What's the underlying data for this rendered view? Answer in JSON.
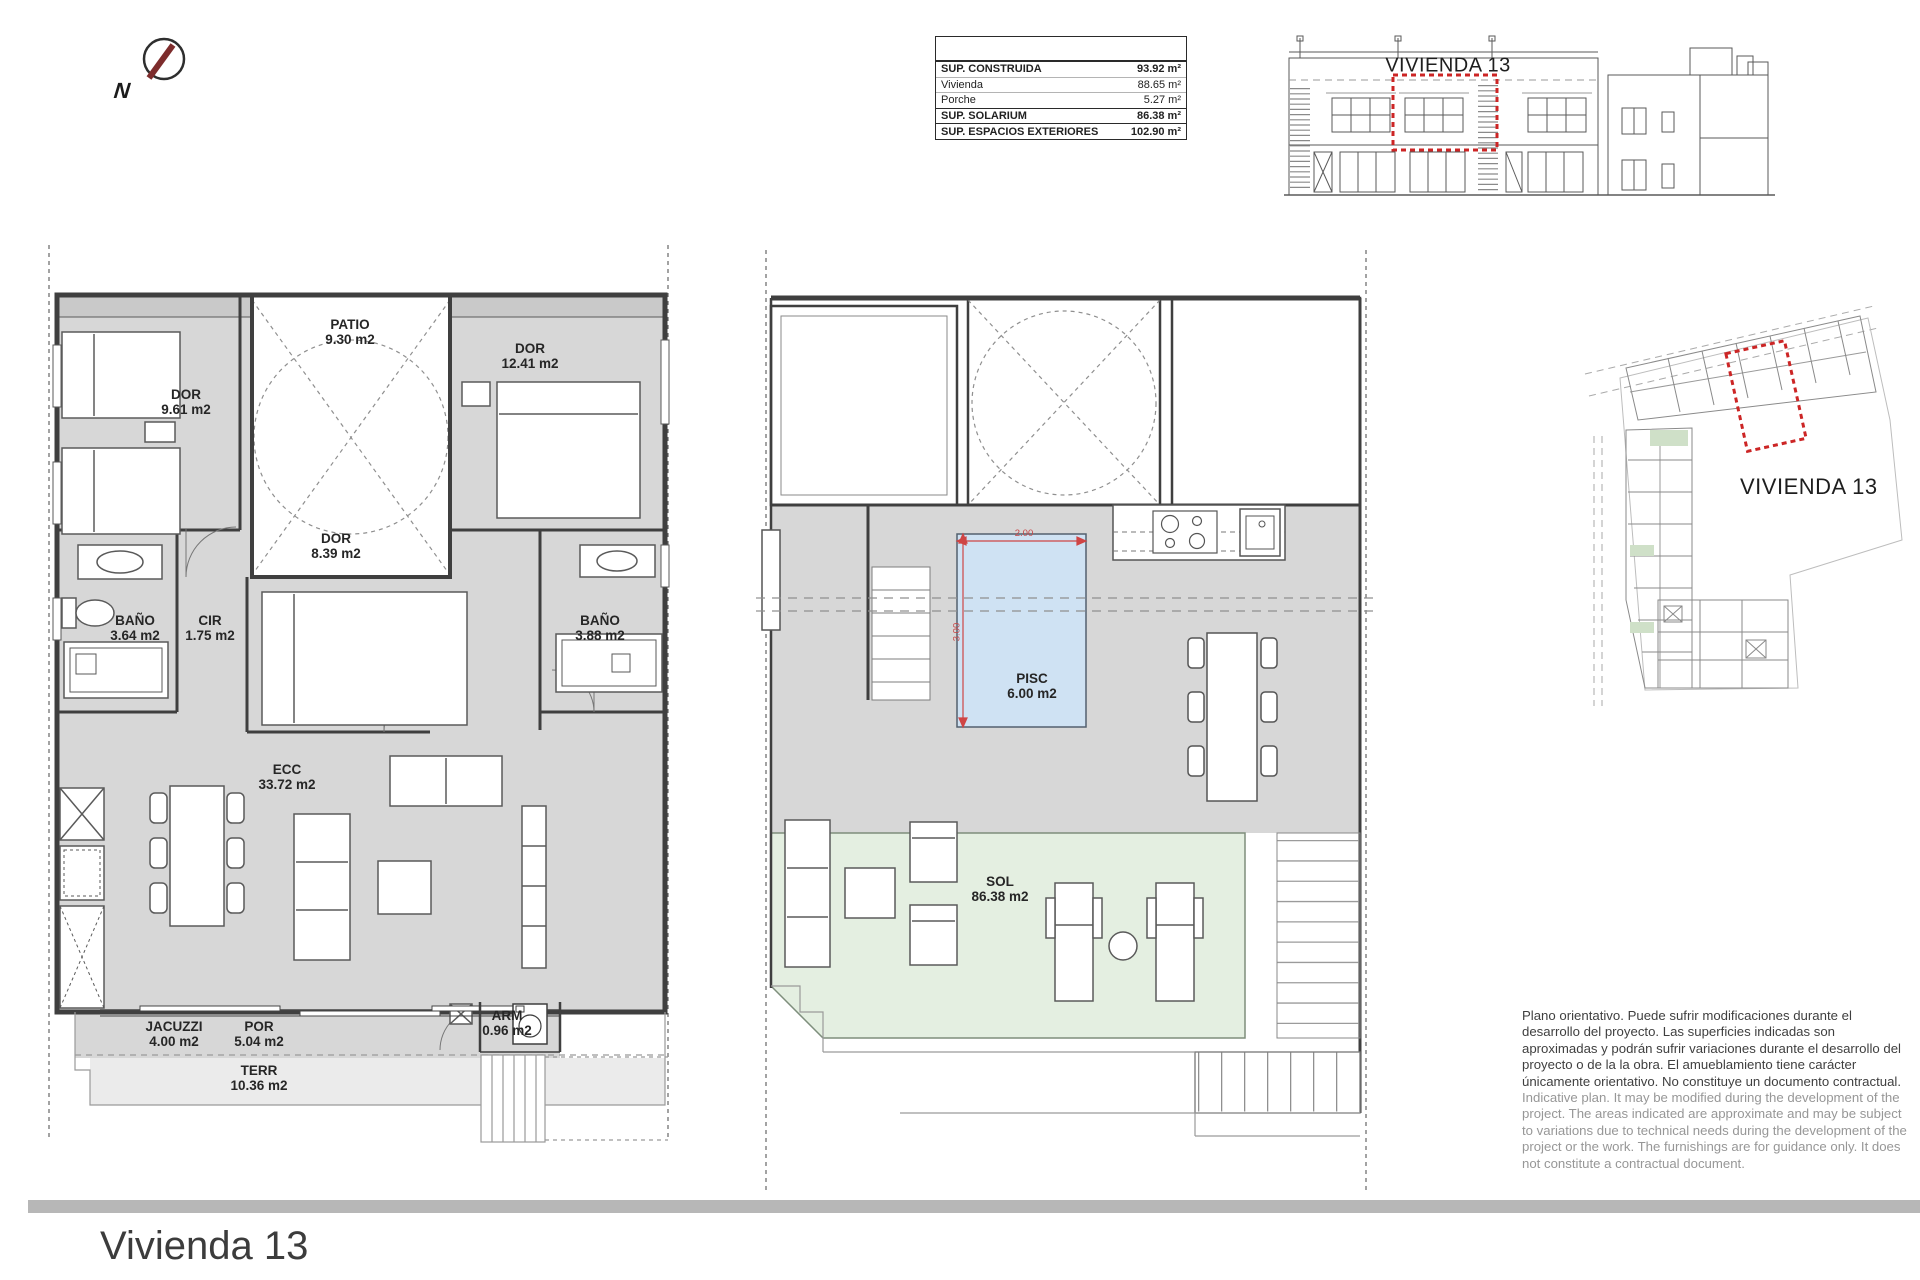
{
  "title": "Vivienda 13",
  "north": {
    "label": "N"
  },
  "areas_table": {
    "rows": [
      {
        "label": "SUP. CONSTRUIDA",
        "value": "93.92 m²"
      },
      {
        "label": "Vivienda",
        "value": "88.65 m²"
      },
      {
        "label": "Porche",
        "value": "5.27 m²"
      },
      {
        "label": "SUP. SOLARIUM",
        "value": "86.38 m²"
      },
      {
        "label": "SUP. ESPACIOS EXTERIORES",
        "value": "102.90 m²"
      }
    ]
  },
  "elevation": {
    "unit_label": "VIVIENDA 13"
  },
  "site_plan": {
    "unit_label": "VIVIENDA 13"
  },
  "floor_plan": {
    "rooms": {
      "dor1": {
        "name": "DOR",
        "area": "9.61 m2"
      },
      "patio": {
        "name": "PATIO",
        "area": "9.30 m2"
      },
      "dor2": {
        "name": "DOR",
        "area": "12.41 m2"
      },
      "dor3": {
        "name": "DOR",
        "area": "8.39 m2"
      },
      "bano1": {
        "name": "BAÑO",
        "area": "3.64 m2"
      },
      "cir": {
        "name": "CIR",
        "area": "1.75 m2"
      },
      "bano2": {
        "name": "BAÑO",
        "area": "3.88 m2"
      },
      "ecc": {
        "name": "ECC",
        "area": "33.72 m2"
      },
      "jacuzzi": {
        "name": "JACUZZI",
        "area": "4.00 m2"
      },
      "por": {
        "name": "POR",
        "area": "5.04 m2"
      },
      "terr": {
        "name": "TERR",
        "area": "10.36 m2"
      },
      "arm": {
        "name": "ARM",
        "area": "0.96 m2"
      }
    }
  },
  "solarium_plan": {
    "rooms": {
      "pisc": {
        "name": "PISC",
        "area": "6.00 m2"
      },
      "sol": {
        "name": "SOL",
        "area": "86.38 m2"
      }
    },
    "pool_dimensions": {
      "width": "2.00",
      "height": "3.00"
    }
  },
  "disclaimer": {
    "es": "Plano orientativo. Puede sufrir modificaciones durante el desarrollo del proyecto. Las superficies indicadas son aproximadas y podrán sufrir variaciones durante el desarrollo del proyecto o de la la obra. El amueblamiento tiene carácter únicamente orientativo. No constituye un documento contractual.",
    "en": "Indicative plan. It may be modified during the development of the project. The areas indicated are approximate and may be subject to variations due to technical needs during the development of the project or the work. The furnishings are for guidance only. It does not constitute a contractual document."
  },
  "colors": {
    "accent_red": "#cc2525",
    "pool_blue": "#cfe2f3",
    "sol_green": "#e4efe1",
    "floor_gray": "#d7d7d7"
  }
}
